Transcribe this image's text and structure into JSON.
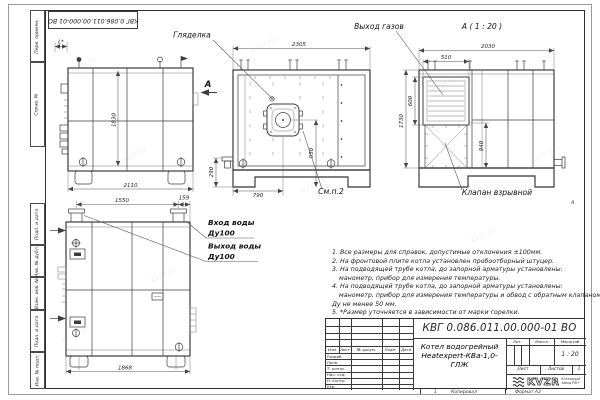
{
  "doc": {
    "number": "КВГ 0.086.011.00.000-01 ВО",
    "name_line1": "Котел водогрейный",
    "name_line2": "Heatexpert-КВа-1,0-ГЛЖ",
    "scale_value": "1 : 20",
    "sheets_value": "1"
  },
  "title_block": {
    "header_cols": [
      "Изм.",
      "Лист",
      "№ докум.",
      "Подп.",
      "Дата"
    ],
    "sig_rows": [
      "Разраб.",
      "Пров.",
      "Т. контр.",
      "Нач. отд.",
      "Н. контр.",
      "Утв."
    ],
    "lit_label": "Лит.",
    "mass_label": "Масса",
    "scale_label": "Масштаб",
    "sheet_label": "Лист",
    "sheets_label": "Листов"
  },
  "logo": {
    "brand": "KVZR",
    "caption1": "Котельный",
    "caption2": "завод РЭП"
  },
  "frame": {
    "margin_labels": [
      "Перв. примен.",
      "Справ. №",
      "Подп. и дата",
      "Инв. № дубл.",
      "Взам. инв. №",
      "Подп. и дата",
      "Инв. № подл."
    ],
    "zone_a": "А",
    "bottom": {
      "zone": "1",
      "copy": "Копировал",
      "format": "Формат А3"
    }
  },
  "notes": [
    "1. Все размеры для справок, допустимые отклонения ±100мм.",
    "2. На фронтовой плите котла установлен пробоотборный штуцер.",
    "3. На подводящей трубе котла, до запорной арматуры установлены:",
    "манометр, прибор для измерения температуры.",
    "4. На подводящей трубе котла, до запорной арматуры установлены:",
    "манометр, прибор для измерения температуры и обвод с обратным клапаном",
    "Ду не менее 50 мм.",
    "5. *Размер уточняется в зависимости от марки горелки."
  ],
  "views": {
    "side": {
      "width": "2110",
      "height": "1830",
      "front_offset": "L*"
    },
    "front": {
      "sight_label": "Гляделка",
      "view_letter": "А",
      "width": "2305",
      "axis_h": "950",
      "axis_x": "790",
      "flange_h": "290",
      "see_note": "См.п.2"
    },
    "rear": {
      "heading": "А ( 1 : 20 )",
      "gas_label": "Выход газов",
      "valve_label": "Клапан взрывной",
      "width": "2030",
      "flue_w": "510",
      "flue_h": "600",
      "height": "1730",
      "lower_h": "940"
    },
    "plan": {
      "inlet_label": "Вход воды",
      "inlet_dn": "Ду100",
      "outlet_label": "Выход воды",
      "outlet_dn": "Ду100",
      "w1": "1550",
      "w2": "159",
      "w_total": "1868"
    }
  },
  "watermark": "kvzr.ru"
}
